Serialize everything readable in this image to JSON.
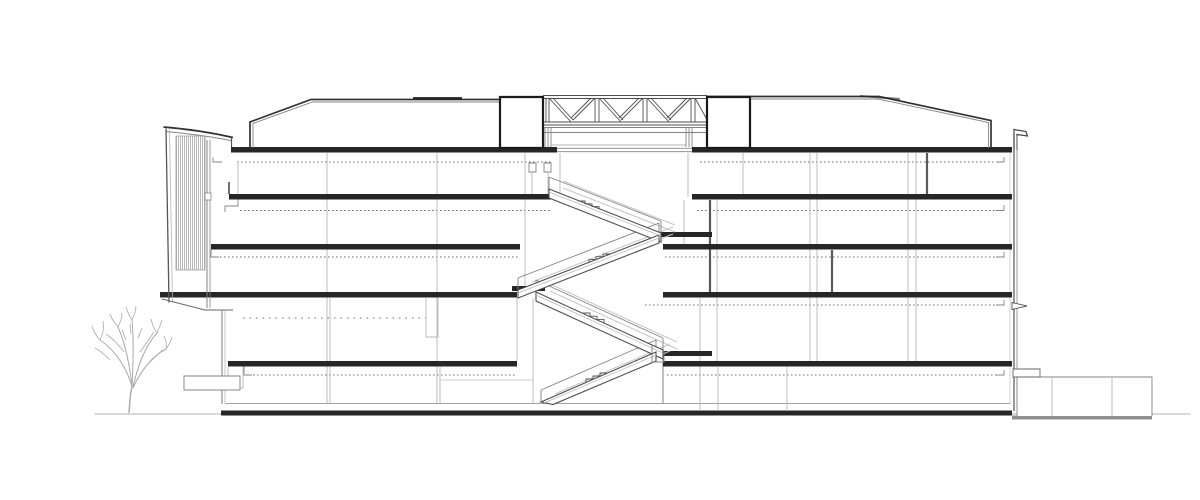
{
  "page": {
    "background": "#ffffff"
  },
  "drawing": {
    "kind": "architectural-building-cross-section",
    "orientation": "longitudinal section / elevation",
    "floors_visible": 5,
    "stair_flights": 4,
    "truss_v_modules": 3,
    "elements": [
      "ground-line",
      "tree",
      "entrance-canopy",
      "hatched-facade-panel",
      "roof-monitor-left",
      "roof-truss",
      "roof-monitor-right",
      "floor-slabs",
      "ceiling-dotted-lines",
      "structural-columns",
      "atrium-switchback-stair",
      "secondary-stair",
      "right-parapet",
      "low-annex",
      "planter-block"
    ]
  },
  "colors": {
    "bg": "#ffffff",
    "ink_strong": "#262626",
    "ink": "#4d4d4d",
    "ink_mid": "#838383",
    "ink_light": "#b5b5b5",
    "ink_faint": "#cfcfcf",
    "dotted": "#6f6f6f",
    "tree": "#a9a9a9",
    "ground_shadow": "#8f8f8f"
  }
}
